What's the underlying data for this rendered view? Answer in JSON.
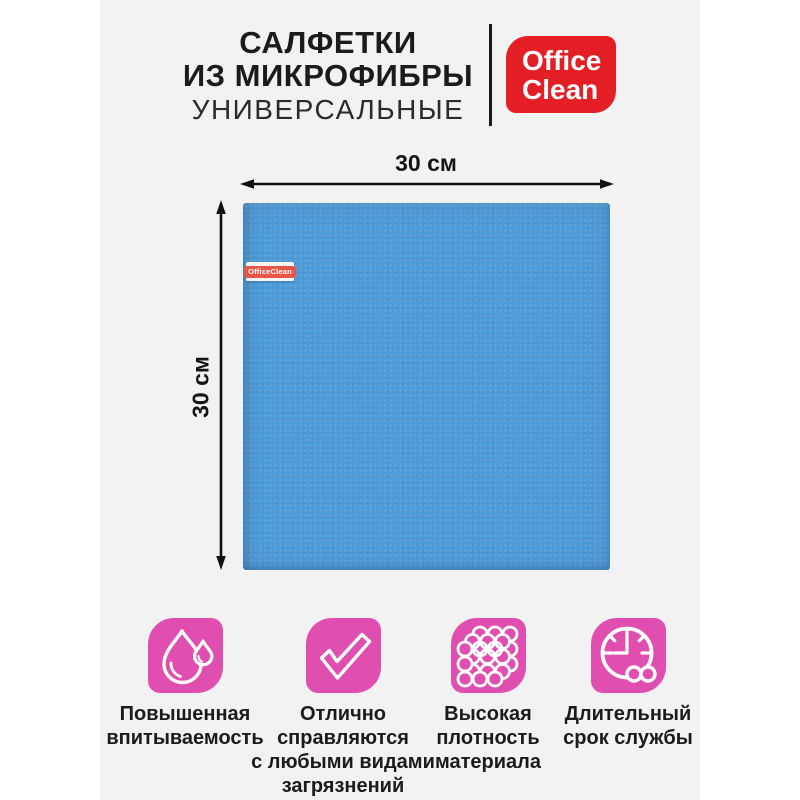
{
  "header": {
    "title_line1": "САЛФЕТКИ",
    "title_line2": "ИЗ МИКРОФИБРЫ",
    "subtitle": "УНИВЕРСАЛЬНЫЕ"
  },
  "brand": {
    "name_line1": "Office",
    "name_line2": "Clean"
  },
  "product": {
    "tag_label": "OfficeClean",
    "width_label": "30 см",
    "height_label": "30 см"
  },
  "features": [
    {
      "icon": "droplet-icon",
      "lines": [
        "Повышенная",
        "впитываемость"
      ]
    },
    {
      "icon": "checkmark-icon",
      "lines": [
        "Отлично",
        "справляются",
        "с любыми видами",
        "загрязнений"
      ]
    },
    {
      "icon": "fiber-density-icon",
      "lines": [
        "Высокая",
        "плотность",
        "материала"
      ]
    },
    {
      "icon": "clock-infinity-icon",
      "lines": [
        "Длительный",
        "срок службы"
      ]
    }
  ],
  "colors": {
    "accent_pink": "#e04fb0",
    "cloth_blue": "#4e9bd9",
    "logo_red": "#e31e24",
    "tag_red": "#e95648",
    "card_background": "#f2f2f2",
    "text": "#1b1b1b"
  }
}
